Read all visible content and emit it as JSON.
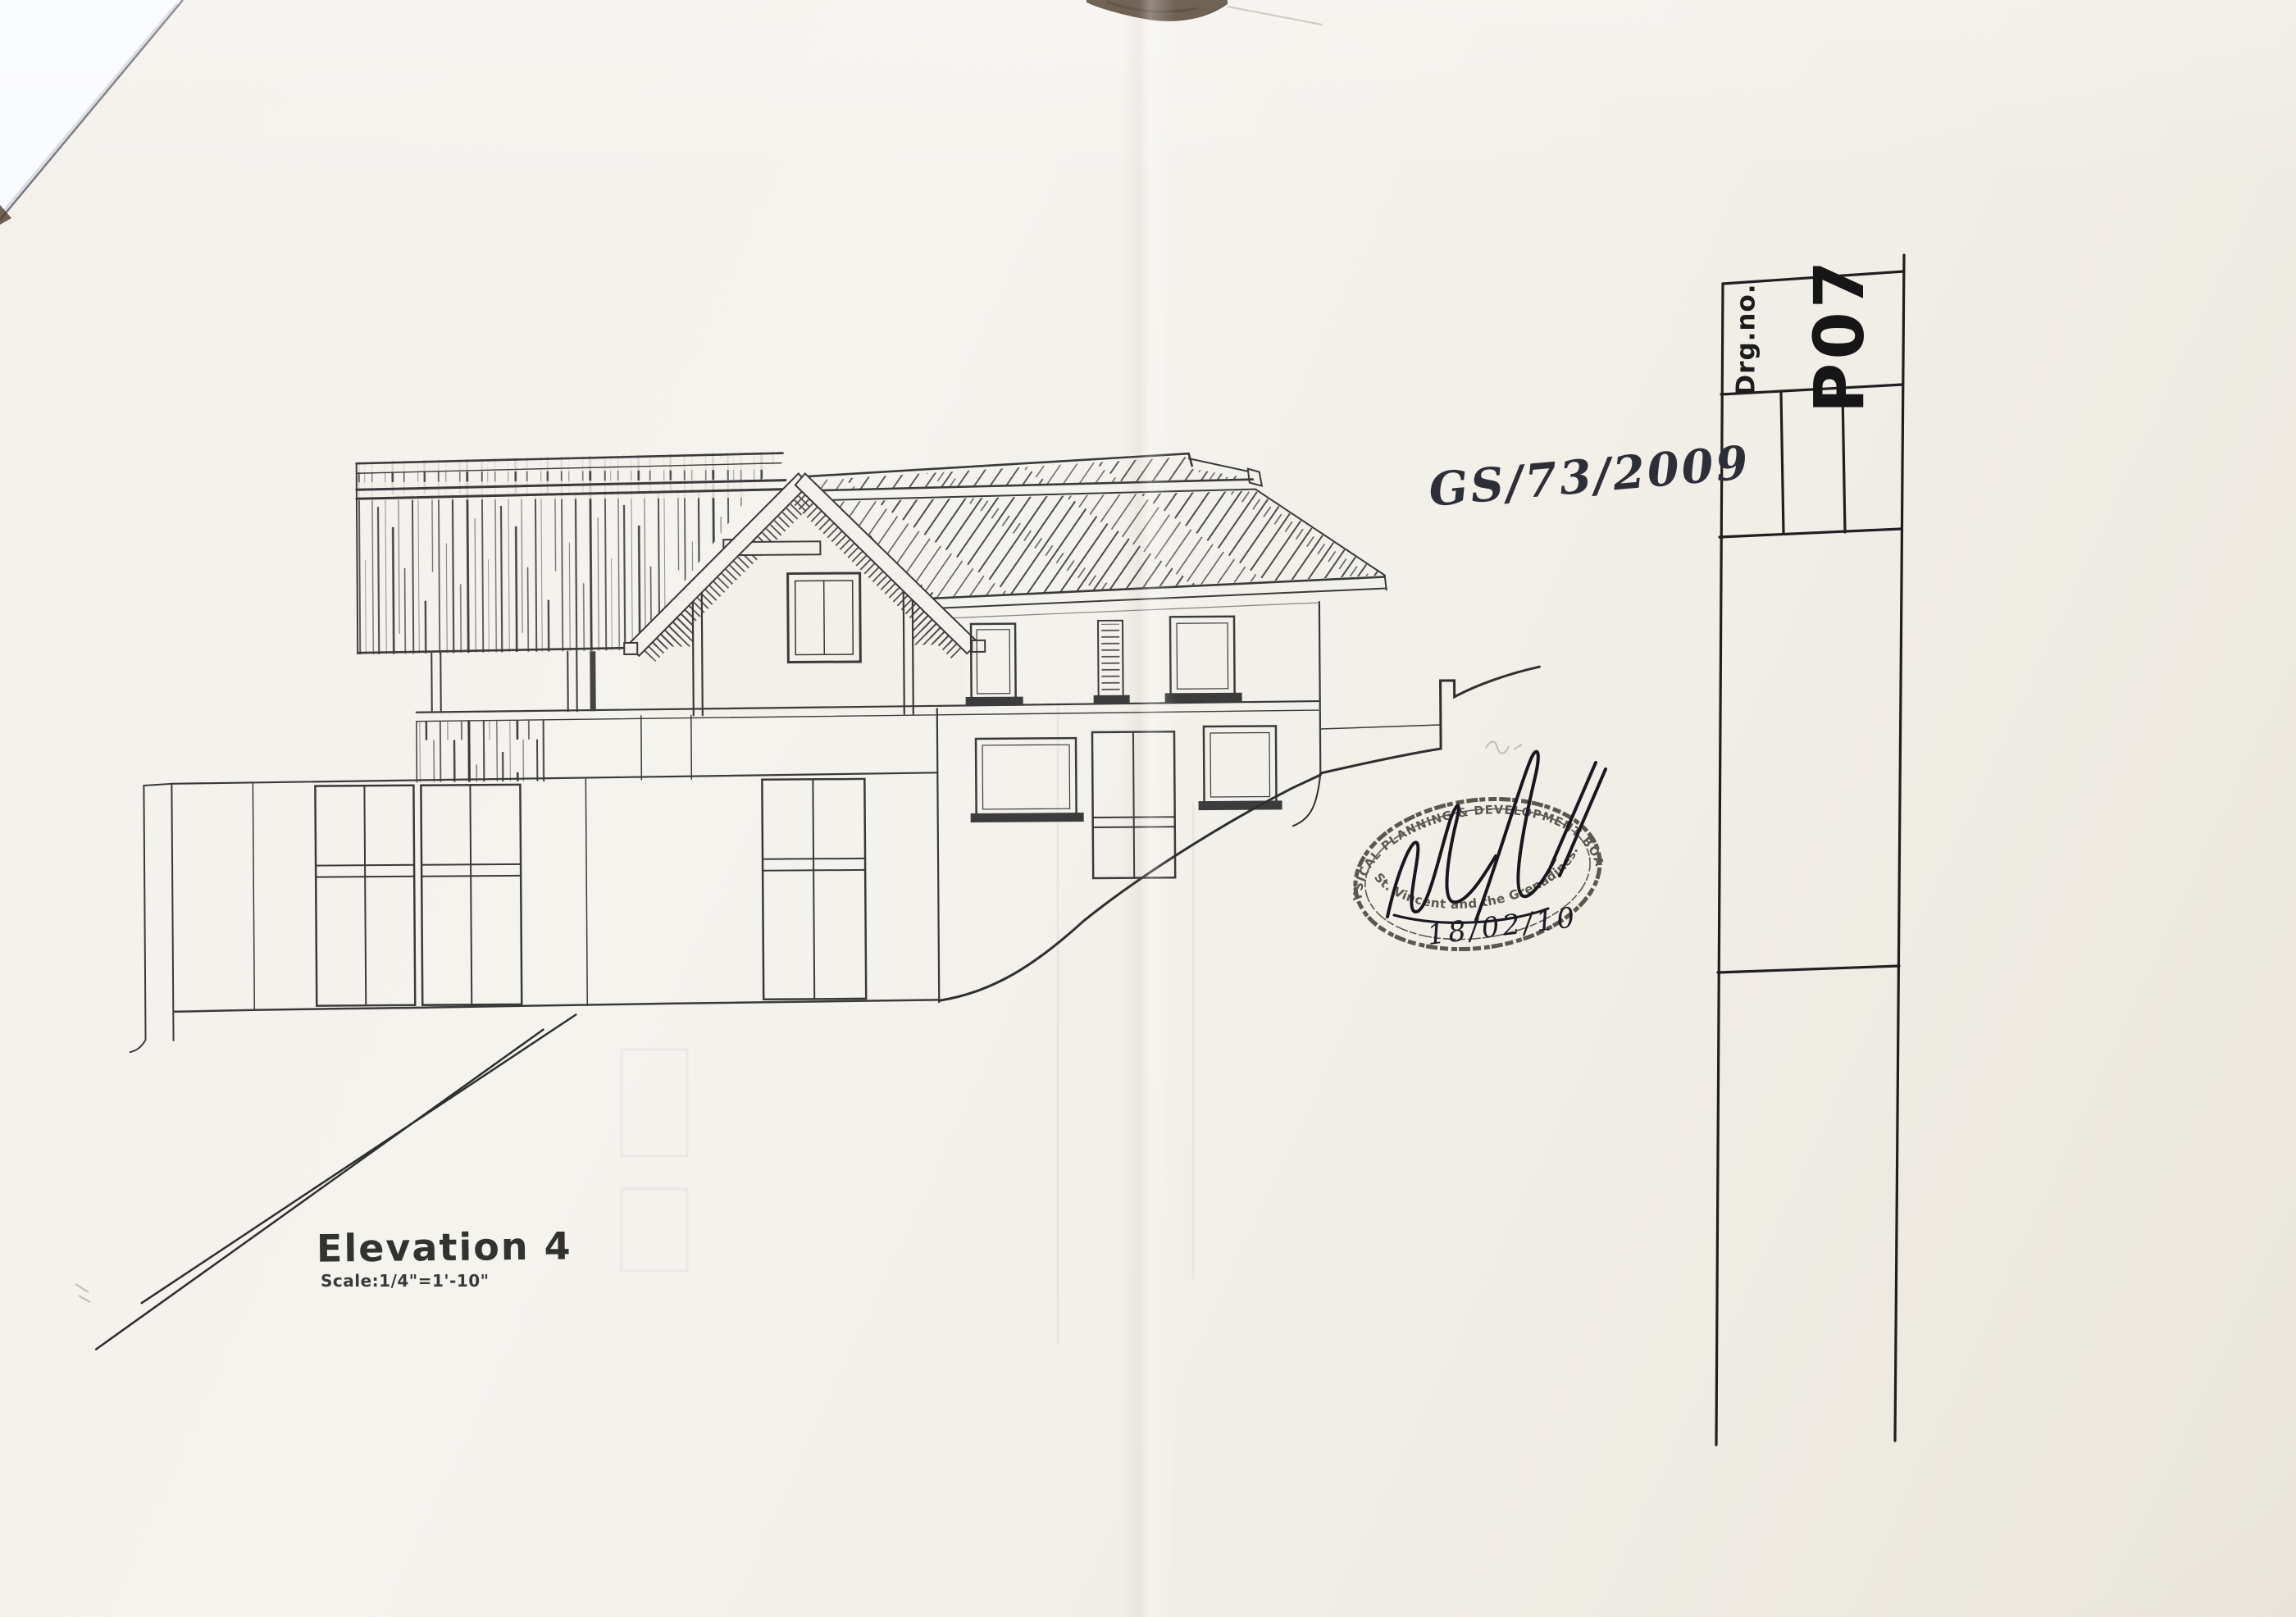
{
  "drawing": {
    "title": "Elevation 4",
    "scale_note": "Scale:1/4\"=1'-10\"",
    "reference_number": "GS/73/2009"
  },
  "stamp": {
    "board_name": "PHYSICAL PLANNING & DEVELOPMENT BOARD",
    "location": "St. Vincent and the Grenadines.",
    "date": "18/02/10"
  },
  "title_block": {
    "drg_no_label": "Drg.no.",
    "drg_no_value": "P07"
  },
  "colors": {
    "paper": "#f3f0ea",
    "ink": "#3a3a3a",
    "stamp_ink": "#43443a",
    "table_edge": "#4e3d2b",
    "under_sheet": "#fafbfd"
  }
}
